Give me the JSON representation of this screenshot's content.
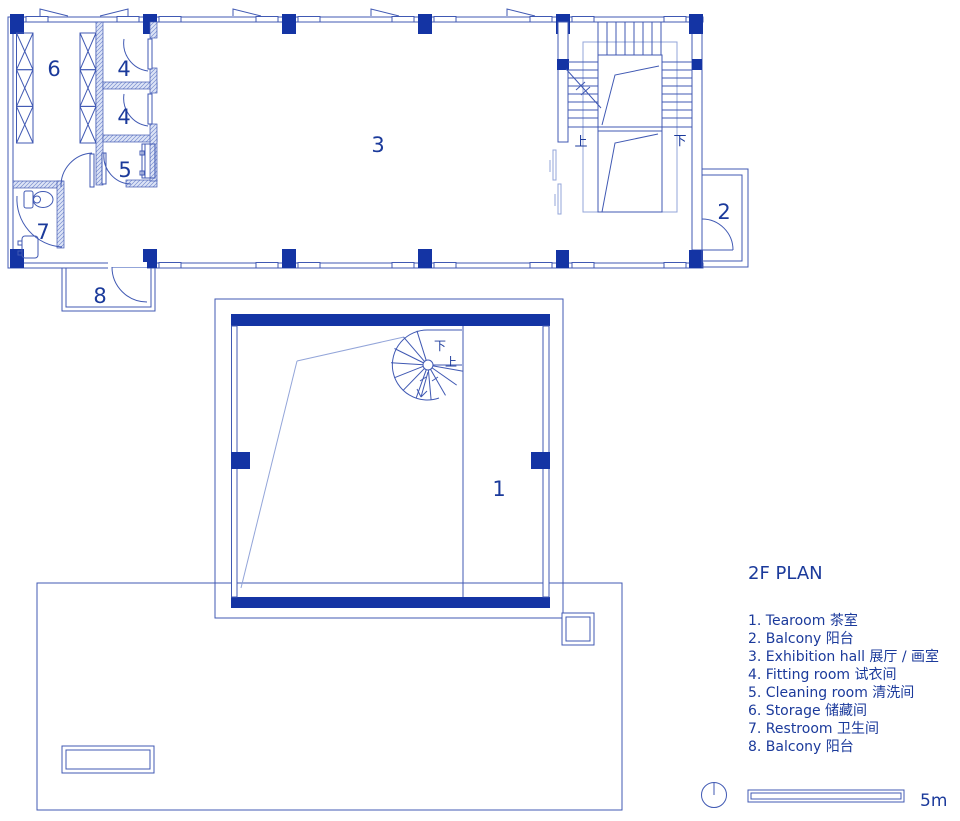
{
  "title": "2F PLAN",
  "legend": {
    "items": [
      {
        "text": "1. Tearoom  茶室"
      },
      {
        "text": "2. Balcony  阳台"
      },
      {
        "text": "3. Exhibition hall  展厅 / 画室"
      },
      {
        "text": "4. Fitting room  试衣间"
      },
      {
        "text": "5. Cleaning room  清洗间"
      },
      {
        "text": "6. Storage  储藏间"
      },
      {
        "text": "7. Restroom  卫生间"
      },
      {
        "text": "8. Balcony  阳台"
      }
    ]
  },
  "plan": {
    "room_labels": {
      "tearoom": "1",
      "balcony_right": "2",
      "exhibition": "3",
      "fitting_a": "4",
      "fitting_b": "4",
      "cleaning": "5",
      "storage": "6",
      "restroom": "7",
      "balcony_bottom": "8"
    },
    "stair_labels": {
      "up": "上",
      "down": "下",
      "spiral_down": "下",
      "spiral_up": "上"
    }
  },
  "scale": {
    "label": "5m"
  },
  "colors": {
    "solid_blue": "#1434a4",
    "line_blue": "#4059b3",
    "light_blue": "#93a5d9",
    "text_blue": "#1b3a9b"
  }
}
